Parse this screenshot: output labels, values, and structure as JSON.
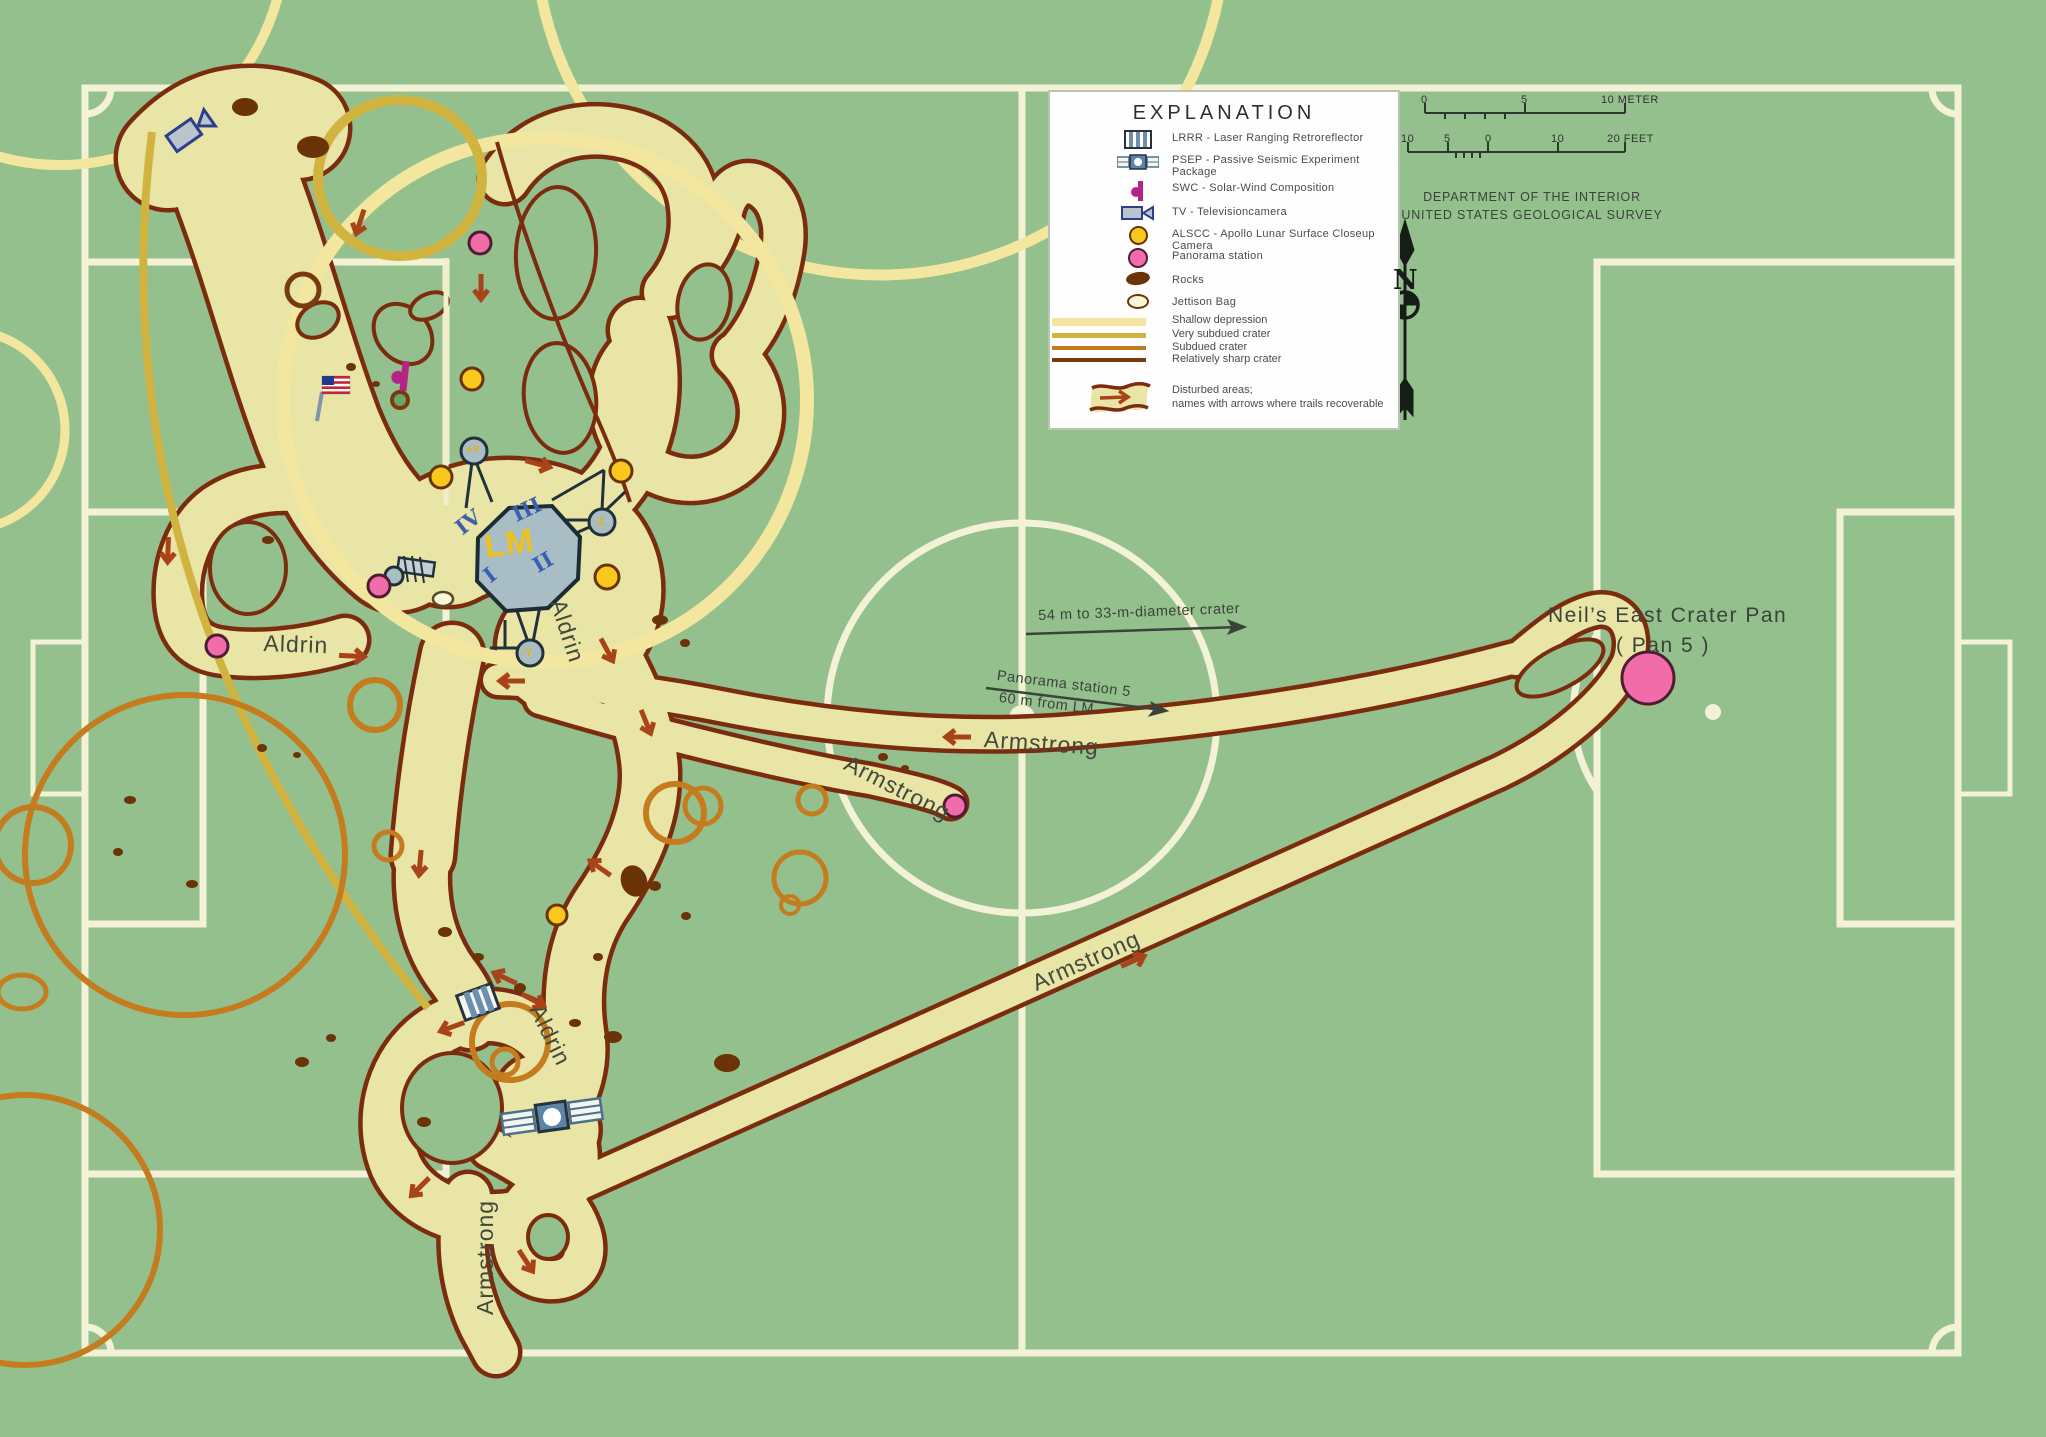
{
  "colors": {
    "field_green": "#93c08c",
    "pitch_line_cream": "#f4f2d6",
    "disturbed_fill": "#e9e5a6",
    "trail_edge_brown": "#7b2c0e",
    "trail_arrow_red": "#a8431a",
    "shallow_depression": "#f3e7a0",
    "very_subdued_crater": "#d1b440",
    "subdued_crater": "#c47c1e",
    "sharp_crater": "#7a3a10",
    "panorama_pink": "#f06daa",
    "alscc_yellow": "#f8c81c",
    "swc_magenta": "#b52384",
    "lm_grey": "#a9bdc5"
  },
  "legend": {
    "title": "EXPLANATION",
    "items": [
      {
        "id": "lrrr",
        "label": "LRRR - Laser Ranging Retroreflector"
      },
      {
        "id": "psep",
        "label": "PSEP - Passive Seismic Experiment Package"
      },
      {
        "id": "swc",
        "label": "SWC - Solar-Wind Composition"
      },
      {
        "id": "tv",
        "label": "TV - Televisioncamera"
      },
      {
        "id": "alscc",
        "label": "ALSCC - Apollo Lunar Surface Closeup Camera"
      },
      {
        "id": "panorama",
        "label": "Panorama station"
      },
      {
        "id": "rocks",
        "label": "Rocks"
      },
      {
        "id": "jettison",
        "label": "Jettison Bag"
      }
    ],
    "bands": [
      {
        "label": "Shallow depression"
      },
      {
        "label": "Very subdued crater"
      },
      {
        "label": "Subdued crater"
      },
      {
        "label": "Relatively sharp crater"
      }
    ],
    "disturbed": {
      "line1": "Disturbed areas;",
      "line2": "names with arrows where trails recoverable"
    }
  },
  "scale_bars": {
    "meter": {
      "tick0": "0",
      "tick5": "5",
      "end": "10 METER"
    },
    "feet": {
      "tick10l": "10",
      "tick5": "5",
      "tick0": "0",
      "tick10r": "10",
      "end": "20 FEET"
    }
  },
  "agency": {
    "line1": "DEPARTMENT OF THE INTERIOR",
    "line2": "UNITED STATES GEOLOGICAL SURVEY"
  },
  "compass": {
    "label": "N"
  },
  "lm": {
    "label": "LM",
    "quadrants": {
      "q1": "I",
      "q2": "II",
      "q3": "III",
      "q4": "IV"
    },
    "pads": {
      "py": "+Y",
      "mz": "-Z",
      "my": "-Y"
    }
  },
  "trail_labels": {
    "aldrin": "Aldrin",
    "armstrong": "Armstrong"
  },
  "annotations": {
    "crater": "54 m to 33-m-diameter crater",
    "pan5_line1": "Panorama station 5",
    "pan5_line2": "60 m from LM",
    "east_pan_line1": "Neil’s East Crater Pan",
    "east_pan_line2": "( Pan 5 )"
  }
}
